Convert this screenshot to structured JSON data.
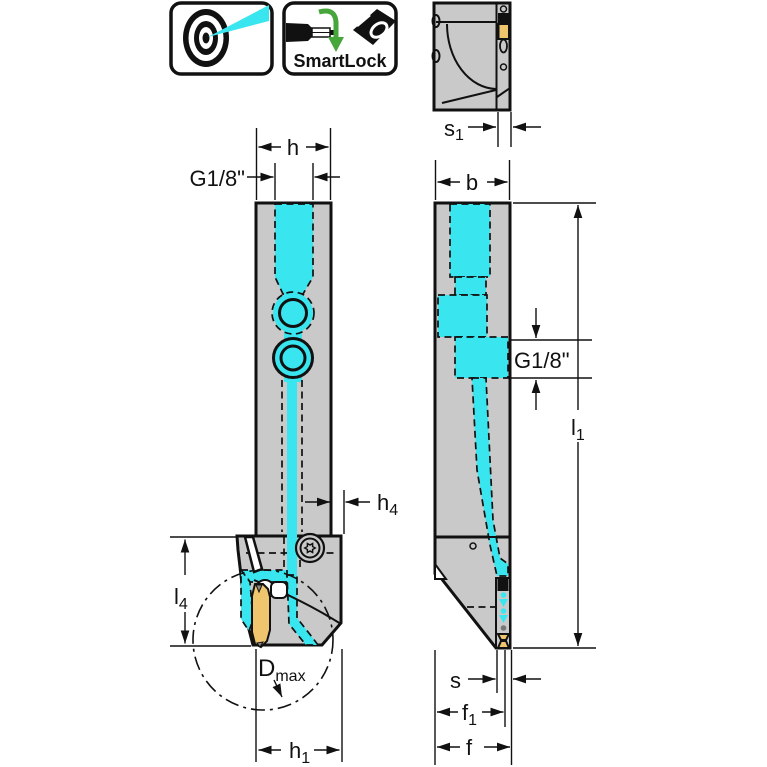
{
  "colors": {
    "body_gray": "#c9c9c9",
    "coolant_cyan": "#39e6f0",
    "insert_yellow": "#efc66e",
    "smartlock_green": "#46a63c",
    "line_black": "#111111"
  },
  "icons": {
    "coolant_spray": "precision-coolant-target-icon",
    "smartlock": "smartlock-rotation-icon",
    "smartlock_label": "SmartLock"
  },
  "views": {
    "top": "top-view",
    "front": "front-view",
    "side": "side-view"
  },
  "dims": {
    "h": {
      "main": "h",
      "sub": ""
    },
    "g18_front": {
      "main": "G1/8\"",
      "sub": ""
    },
    "h4": {
      "main": "h",
      "sub": "4"
    },
    "l4": {
      "main": "l",
      "sub": "4"
    },
    "dmax": {
      "main": "D",
      "sub": "max"
    },
    "h1": {
      "main": "h",
      "sub": "1"
    },
    "s1": {
      "main": "s",
      "sub": "1"
    },
    "b": {
      "main": "b",
      "sub": ""
    },
    "g18_side": {
      "main": "G1/8\"",
      "sub": ""
    },
    "l1": {
      "main": "l",
      "sub": "1"
    },
    "s": {
      "main": "s",
      "sub": ""
    },
    "f1": {
      "main": "f",
      "sub": "1"
    },
    "f": {
      "main": "f",
      "sub": ""
    }
  }
}
